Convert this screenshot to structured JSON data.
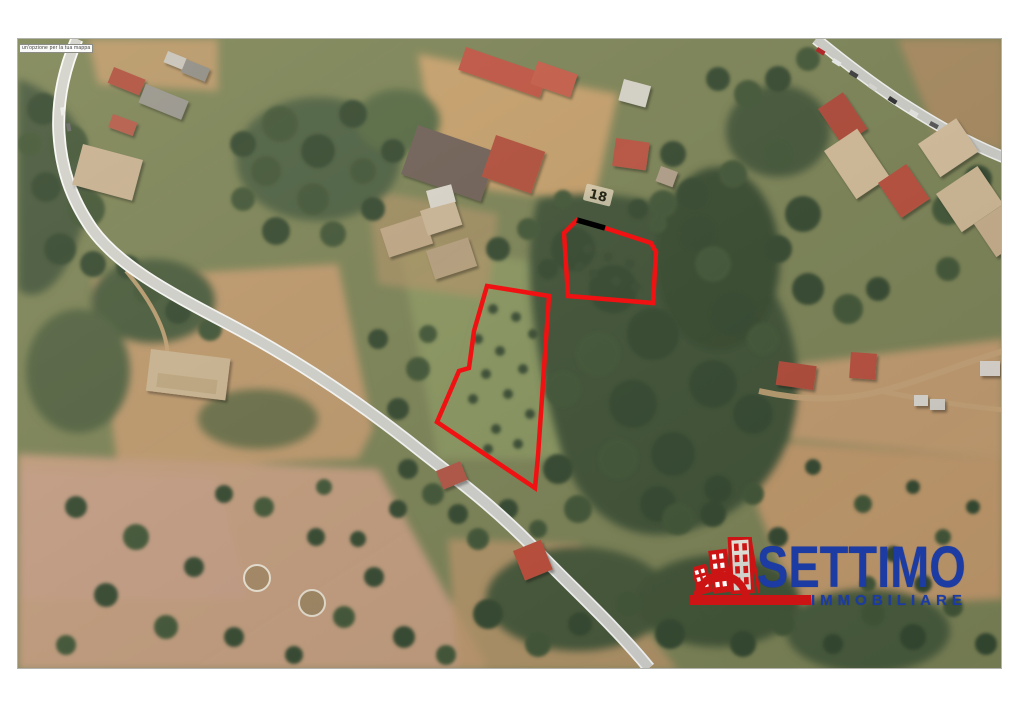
{
  "attribution_label": "un'opzione per la tua mappa",
  "ground_marking": "18",
  "logo": {
    "title": "SETTIMO",
    "subtitle": "IMMOBILIARE"
  },
  "colors": {
    "logo_blue": "#1c3ca3",
    "logo_red": "#cd1414",
    "parcel_red": "#f01212",
    "parcel_cap": "#000000"
  }
}
